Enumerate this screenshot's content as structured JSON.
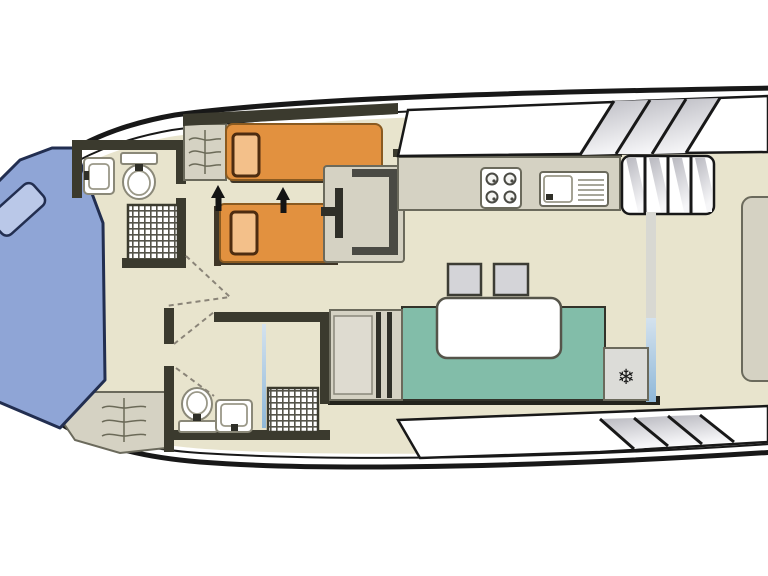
{
  "canvas": {
    "width": 768,
    "height": 576,
    "background": "#ffffff"
  },
  "palette": {
    "floor": "#e8e4cd",
    "wall": "#3b3a2e",
    "hull": "#181818",
    "bed_orange": "#e2913f",
    "bed_orange_border": "#8a5a20",
    "bed_shadow": "#3f3627",
    "pillow_orange": "#f3c08a",
    "pillow_border": "#4d2c10",
    "bed_blue": "#8fa5d6",
    "bed_blue_border": "#222e50",
    "pillow_blue": "#bac8e8",
    "dinette_teal": "#82bda9",
    "unit_gray": "#d5d2c3",
    "unit_border": "#6b6a5c",
    "door_dash": "#8a8478"
  },
  "icons": {
    "fridge_snowflake": "❄"
  }
}
